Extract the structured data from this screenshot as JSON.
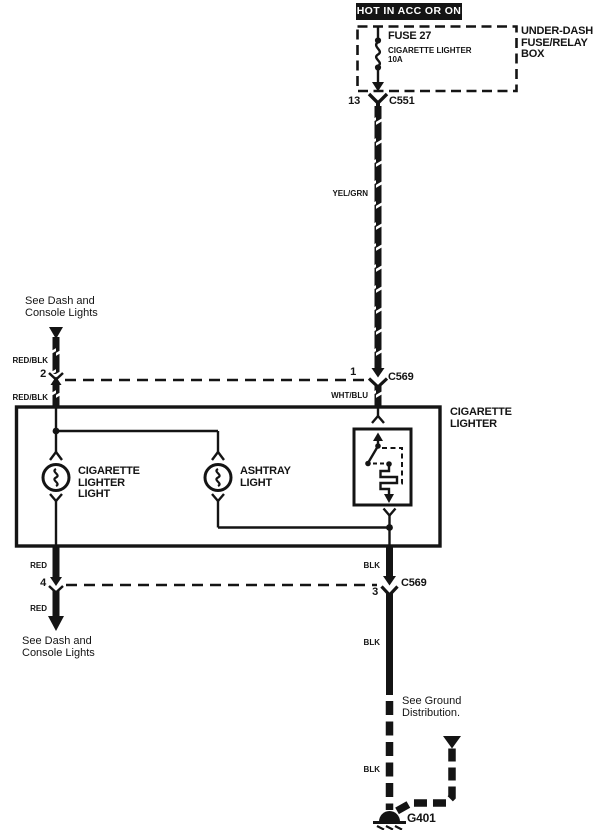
{
  "power": {
    "label": "HOT IN ACC OR ON"
  },
  "fuse_box": {
    "label_line1": "UNDER-DASH",
    "label_line2": "FUSE/RELAY",
    "label_line3": "BOX",
    "fuse_name": "FUSE 27",
    "fuse_desc": "CIGARETTE LIGHTER",
    "fuse_rating": "10A"
  },
  "connectors": {
    "c551": {
      "pin": "13",
      "name": "C551"
    },
    "c569_top": {
      "pin_left": "2",
      "pin_right": "1",
      "name": "C569"
    },
    "c569_bottom": {
      "pin_left": "4",
      "pin_right": "3",
      "name": "C569"
    }
  },
  "wires": {
    "yel_grn": "YEL/GRN",
    "wht_blu": "WHT/BLU",
    "red_blk_upper": "RED/BLK",
    "red_blk_lower": "RED/BLK",
    "red_upper": "RED",
    "red_lower": "RED",
    "blk_1": "BLK",
    "blk_2": "BLK",
    "blk_3": "BLK"
  },
  "notes": {
    "dash_top_1": "See Dash and",
    "dash_top_2": "Console Lights",
    "dash_bottom_1": "See Dash and",
    "dash_bottom_2": "Console Lights",
    "ground_1": "See Ground",
    "ground_2": "Distribution."
  },
  "component": {
    "line1": "CIGARETTE",
    "line2": "LIGHTER"
  },
  "bulbs": {
    "b1_line1": "CIGARETTE",
    "b1_line2": "LIGHTER",
    "b1_line3": "LIGHT",
    "b2_line1": "ASHTRAY",
    "b2_line2": "LIGHT"
  },
  "ground": {
    "name": "G401"
  },
  "colors": {
    "ink": "#141414",
    "paper": "#ffffff"
  }
}
